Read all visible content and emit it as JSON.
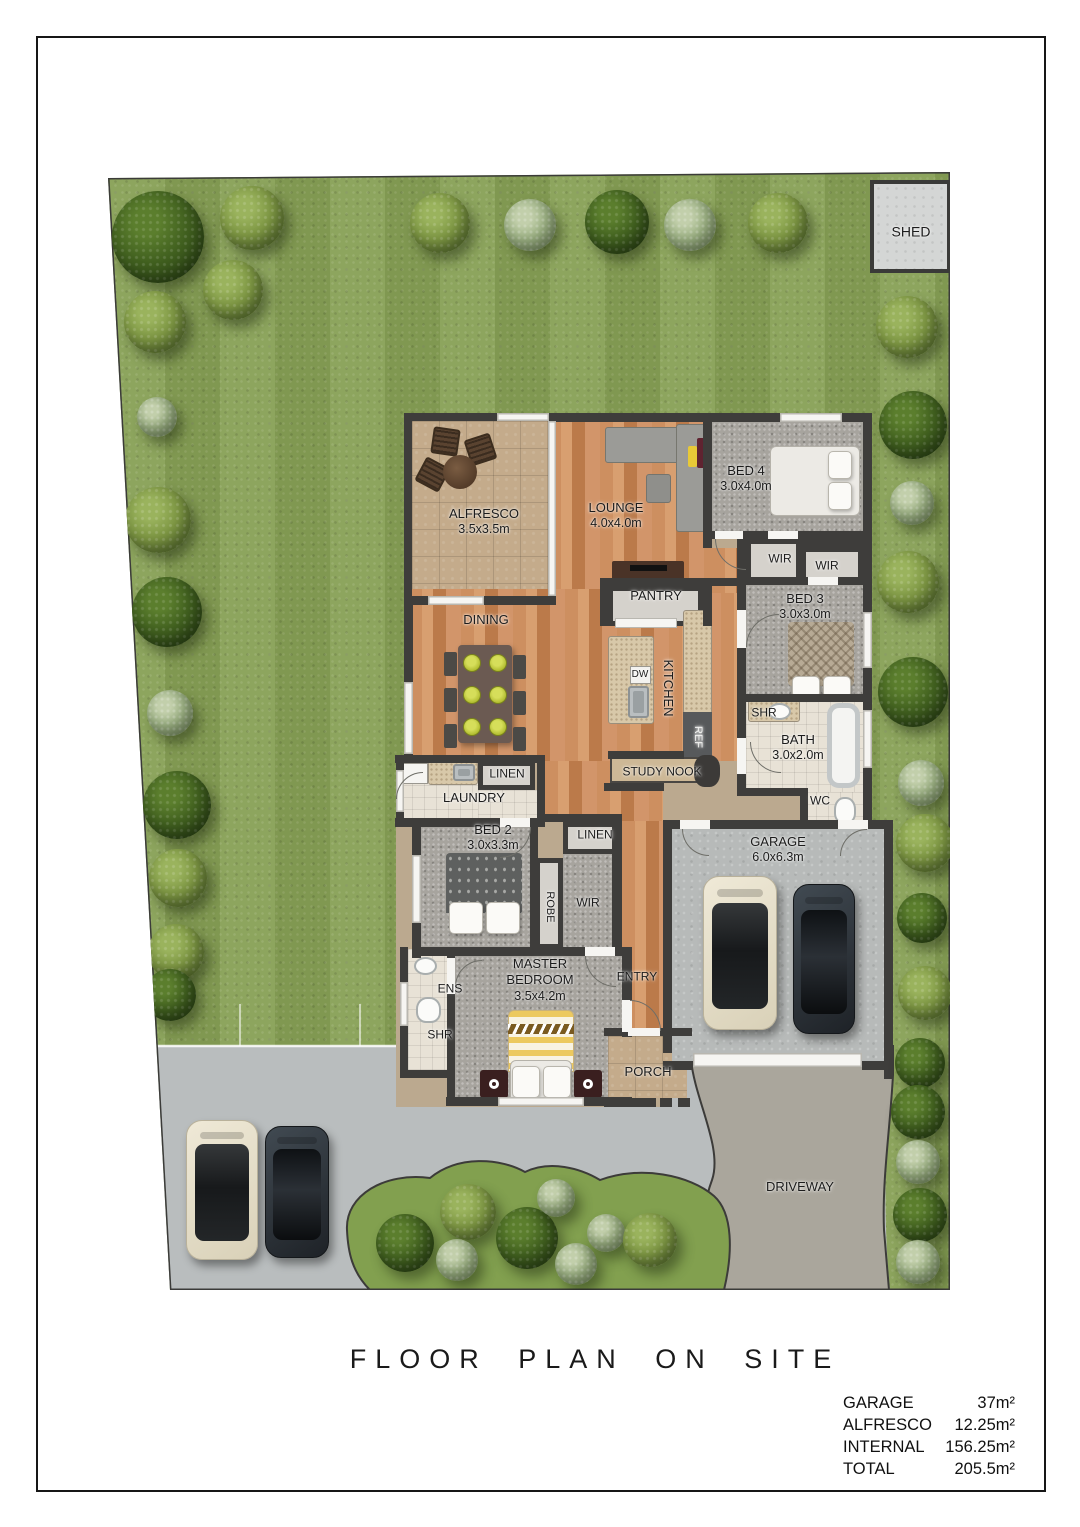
{
  "page": {
    "title": "FLOOR PLAN ON SITE"
  },
  "legend": {
    "rows": [
      {
        "label": "GARAGE",
        "value": "37m²"
      },
      {
        "label": "ALFRESCO",
        "value": "12.25m²"
      },
      {
        "label": "INTERNAL",
        "value": "156.25m²"
      },
      {
        "label": "TOTAL",
        "value": "205.5m²"
      }
    ]
  },
  "plan": {
    "labels": [
      {
        "id": "shed",
        "label": "SHED",
        "x": 911,
        "y": 232,
        "size": 14
      },
      {
        "id": "alfresco",
        "label": "ALFRESCO",
        "dims": "3.5x3.5m",
        "x": 484,
        "y": 522
      },
      {
        "id": "lounge",
        "label": "LOUNGE",
        "dims": "4.0x4.0m",
        "x": 616,
        "y": 516
      },
      {
        "id": "bed4",
        "label": "BED 4",
        "dims": "3.0x4.0m",
        "x": 746,
        "y": 479
      },
      {
        "id": "wir1",
        "label": "WIR",
        "x": 780,
        "y": 559,
        "size": 12
      },
      {
        "id": "wir2",
        "label": "WIR",
        "x": 827,
        "y": 566,
        "size": 12
      },
      {
        "id": "bed3",
        "label": "BED 3",
        "dims": "3.0x3.0m",
        "x": 805,
        "y": 607
      },
      {
        "id": "pantry",
        "label": "PANTRY",
        "x": 656,
        "y": 596
      },
      {
        "id": "dining",
        "label": "DINING",
        "x": 486,
        "y": 620
      },
      {
        "id": "kitchen",
        "label": "KITCHEN",
        "x": 668,
        "y": 688,
        "rot": 90
      },
      {
        "id": "dw",
        "label": "DW",
        "x": 640,
        "y": 675,
        "size": 10
      },
      {
        "id": "ref",
        "label": "REF",
        "x": 697,
        "y": 737,
        "rot": 90,
        "size": 11,
        "color": "#f2f2f0"
      },
      {
        "id": "studynook",
        "label": "STUDY NOOK",
        "x": 662,
        "y": 772,
        "size": 12
      },
      {
        "id": "shr-bath",
        "label": "SHR",
        "x": 764,
        "y": 713,
        "size": 12
      },
      {
        "id": "bath",
        "label": "BATH",
        "dims": "3.0x2.0m",
        "x": 798,
        "y": 748
      },
      {
        "id": "wc",
        "label": "WC",
        "x": 820,
        "y": 801,
        "size": 12
      },
      {
        "id": "linen1",
        "label": "LINEN",
        "x": 507,
        "y": 774,
        "size": 12
      },
      {
        "id": "laundry",
        "label": "LAUNDRY",
        "x": 474,
        "y": 798
      },
      {
        "id": "bed2",
        "label": "BED 2",
        "dims": "3.0x3.3m",
        "x": 493,
        "y": 838
      },
      {
        "id": "linen2",
        "label": "LINEN",
        "x": 595,
        "y": 835,
        "size": 12
      },
      {
        "id": "robe",
        "label": "ROBE",
        "x": 549,
        "y": 907,
        "rot": 90,
        "size": 11
      },
      {
        "id": "wir3",
        "label": "WIR",
        "x": 588,
        "y": 903,
        "size": 12
      },
      {
        "id": "entry",
        "label": "ENTRY",
        "x": 637,
        "y": 977,
        "size": 12
      },
      {
        "id": "master",
        "label": "MASTER\nBEDROOM",
        "dims": "3.5x4.2m",
        "x": 540,
        "y": 980
      },
      {
        "id": "ens",
        "label": "ENS",
        "x": 450,
        "y": 989,
        "size": 12
      },
      {
        "id": "shr-ens",
        "label": "SHR",
        "x": 440,
        "y": 1035,
        "size": 12
      },
      {
        "id": "porch",
        "label": "PORCH",
        "x": 648,
        "y": 1072
      },
      {
        "id": "garage",
        "label": "GARAGE",
        "dims": "6.0x6.3m",
        "x": 778,
        "y": 850
      },
      {
        "id": "driveway",
        "label": "DRIVEWAY",
        "x": 800,
        "y": 1187
      }
    ]
  },
  "site": {
    "colors": {
      "grass": "#87a055",
      "concrete": "#b9bdbe",
      "driveway": "#a9a69d",
      "wall": "#3e3d3b",
      "wood": "#c9895b"
    },
    "trees": [
      {
        "x": 158,
        "y": 237,
        "r": 46,
        "v": "dark"
      },
      {
        "x": 252,
        "y": 218,
        "r": 32,
        "v": "light"
      },
      {
        "x": 233,
        "y": 290,
        "r": 30,
        "v": "light"
      },
      {
        "x": 155,
        "y": 322,
        "r": 31,
        "v": "light"
      },
      {
        "x": 157,
        "y": 417,
        "r": 20,
        "v": "pale"
      },
      {
        "x": 440,
        "y": 223,
        "r": 30,
        "v": "light"
      },
      {
        "x": 530,
        "y": 225,
        "r": 26,
        "v": "pale"
      },
      {
        "x": 617,
        "y": 222,
        "r": 32,
        "v": "dark"
      },
      {
        "x": 690,
        "y": 225,
        "r": 26,
        "v": "pale"
      },
      {
        "x": 778,
        "y": 223,
        "r": 30,
        "v": "light"
      },
      {
        "x": 158,
        "y": 520,
        "r": 33,
        "v": "light"
      },
      {
        "x": 167,
        "y": 612,
        "r": 35,
        "v": "dark"
      },
      {
        "x": 170,
        "y": 713,
        "r": 23,
        "v": "pale"
      },
      {
        "x": 177,
        "y": 805,
        "r": 34,
        "v": "dark"
      },
      {
        "x": 178,
        "y": 878,
        "r": 29,
        "v": "light"
      },
      {
        "x": 176,
        "y": 952,
        "r": 28,
        "v": "light"
      },
      {
        "x": 170,
        "y": 995,
        "r": 26,
        "v": "dark"
      },
      {
        "x": 907,
        "y": 327,
        "r": 31,
        "v": "light"
      },
      {
        "x": 913,
        "y": 425,
        "r": 34,
        "v": "dark"
      },
      {
        "x": 912,
        "y": 503,
        "r": 22,
        "v": "pale"
      },
      {
        "x": 908,
        "y": 582,
        "r": 31,
        "v": "light"
      },
      {
        "x": 913,
        "y": 692,
        "r": 35,
        "v": "dark"
      },
      {
        "x": 921,
        "y": 783,
        "r": 23,
        "v": "pale"
      },
      {
        "x": 925,
        "y": 843,
        "r": 29,
        "v": "light"
      },
      {
        "x": 922,
        "y": 918,
        "r": 25,
        "v": "dark"
      },
      {
        "x": 925,
        "y": 993,
        "r": 27,
        "v": "light"
      },
      {
        "x": 920,
        "y": 1063,
        "r": 25,
        "v": "dark"
      },
      {
        "x": 918,
        "y": 1112,
        "r": 27,
        "v": "dark"
      },
      {
        "x": 918,
        "y": 1162,
        "r": 22,
        "v": "pale"
      },
      {
        "x": 920,
        "y": 1215,
        "r": 27,
        "v": "dark"
      },
      {
        "x": 918,
        "y": 1262,
        "r": 22,
        "v": "pale"
      },
      {
        "x": 405,
        "y": 1243,
        "r": 29,
        "v": "dark"
      },
      {
        "x": 468,
        "y": 1212,
        "r": 28,
        "v": "light"
      },
      {
        "x": 457,
        "y": 1260,
        "r": 21,
        "v": "pale"
      },
      {
        "x": 527,
        "y": 1238,
        "r": 31,
        "v": "dark"
      },
      {
        "x": 556,
        "y": 1198,
        "r": 19,
        "v": "pale"
      },
      {
        "x": 576,
        "y": 1264,
        "r": 21,
        "v": "pale"
      },
      {
        "x": 606,
        "y": 1233,
        "r": 19,
        "v": "pale"
      },
      {
        "x": 650,
        "y": 1240,
        "r": 27,
        "v": "light"
      }
    ]
  }
}
